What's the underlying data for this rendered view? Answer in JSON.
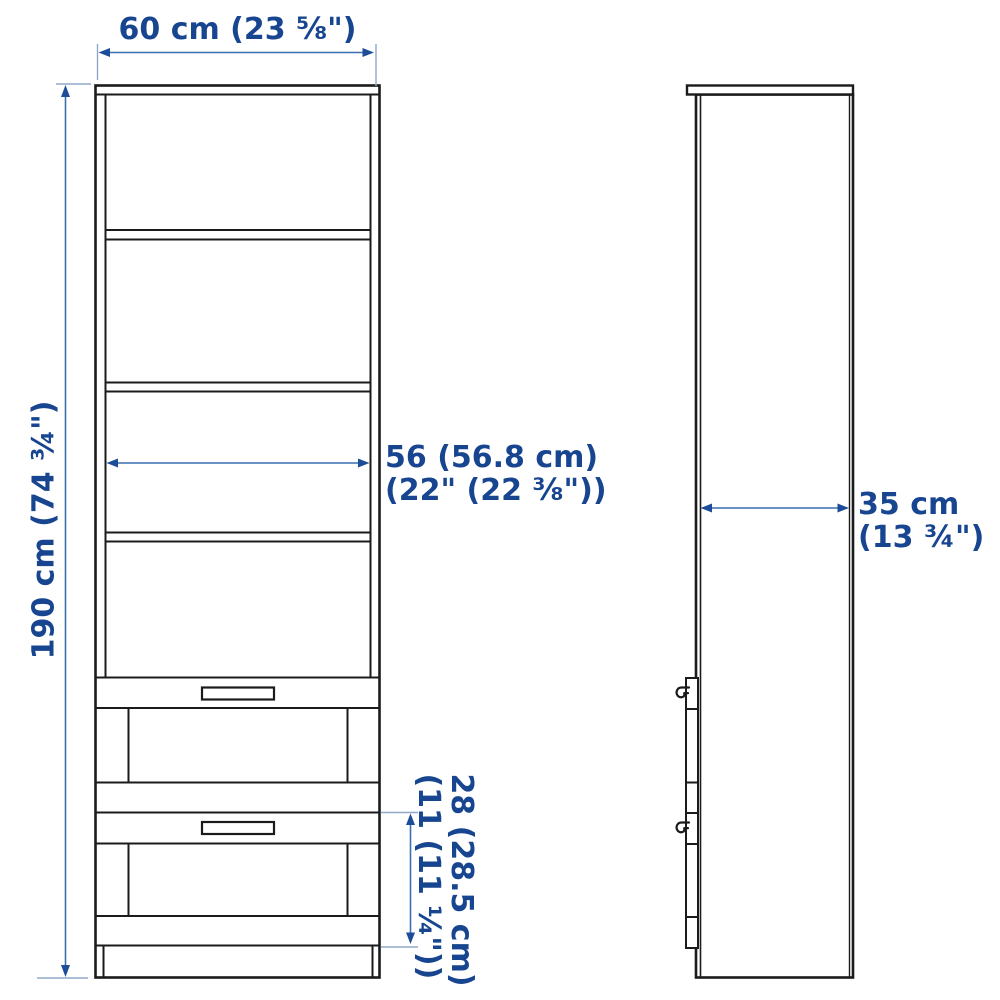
{
  "diagram": {
    "kind": "furniture dimension illustration",
    "views": [
      {
        "id": "front",
        "description": "bookcase front elevation: four open shelf compartments above two drawers with handles"
      },
      {
        "id": "side",
        "description": "bookcase side profile: tall panel with overhanging top, drawer fronts and two knobs"
      }
    ],
    "labels": {
      "width": "60 cm (23 ⅝\")",
      "height": "190 cm (74 ¾\")",
      "shelf_width_line1": "56 (56.8 cm)",
      "shelf_width_line2": "(22\" (22 ⅜\"))",
      "depth_line1": "35 cm",
      "depth_line2": "(13 ¾\")",
      "drawer_height_line1": "28 (28.5 cm)",
      "drawer_height_line2": "(11 (11 ¼\"))"
    },
    "colors": {
      "background": "#ffffff",
      "outline": "#1b1b1b",
      "dimension_text": "#17458f",
      "dimension_line": "#3a6fb0",
      "arrowhead": "#1d4d99",
      "extension_line": "#8fa9c7"
    }
  }
}
